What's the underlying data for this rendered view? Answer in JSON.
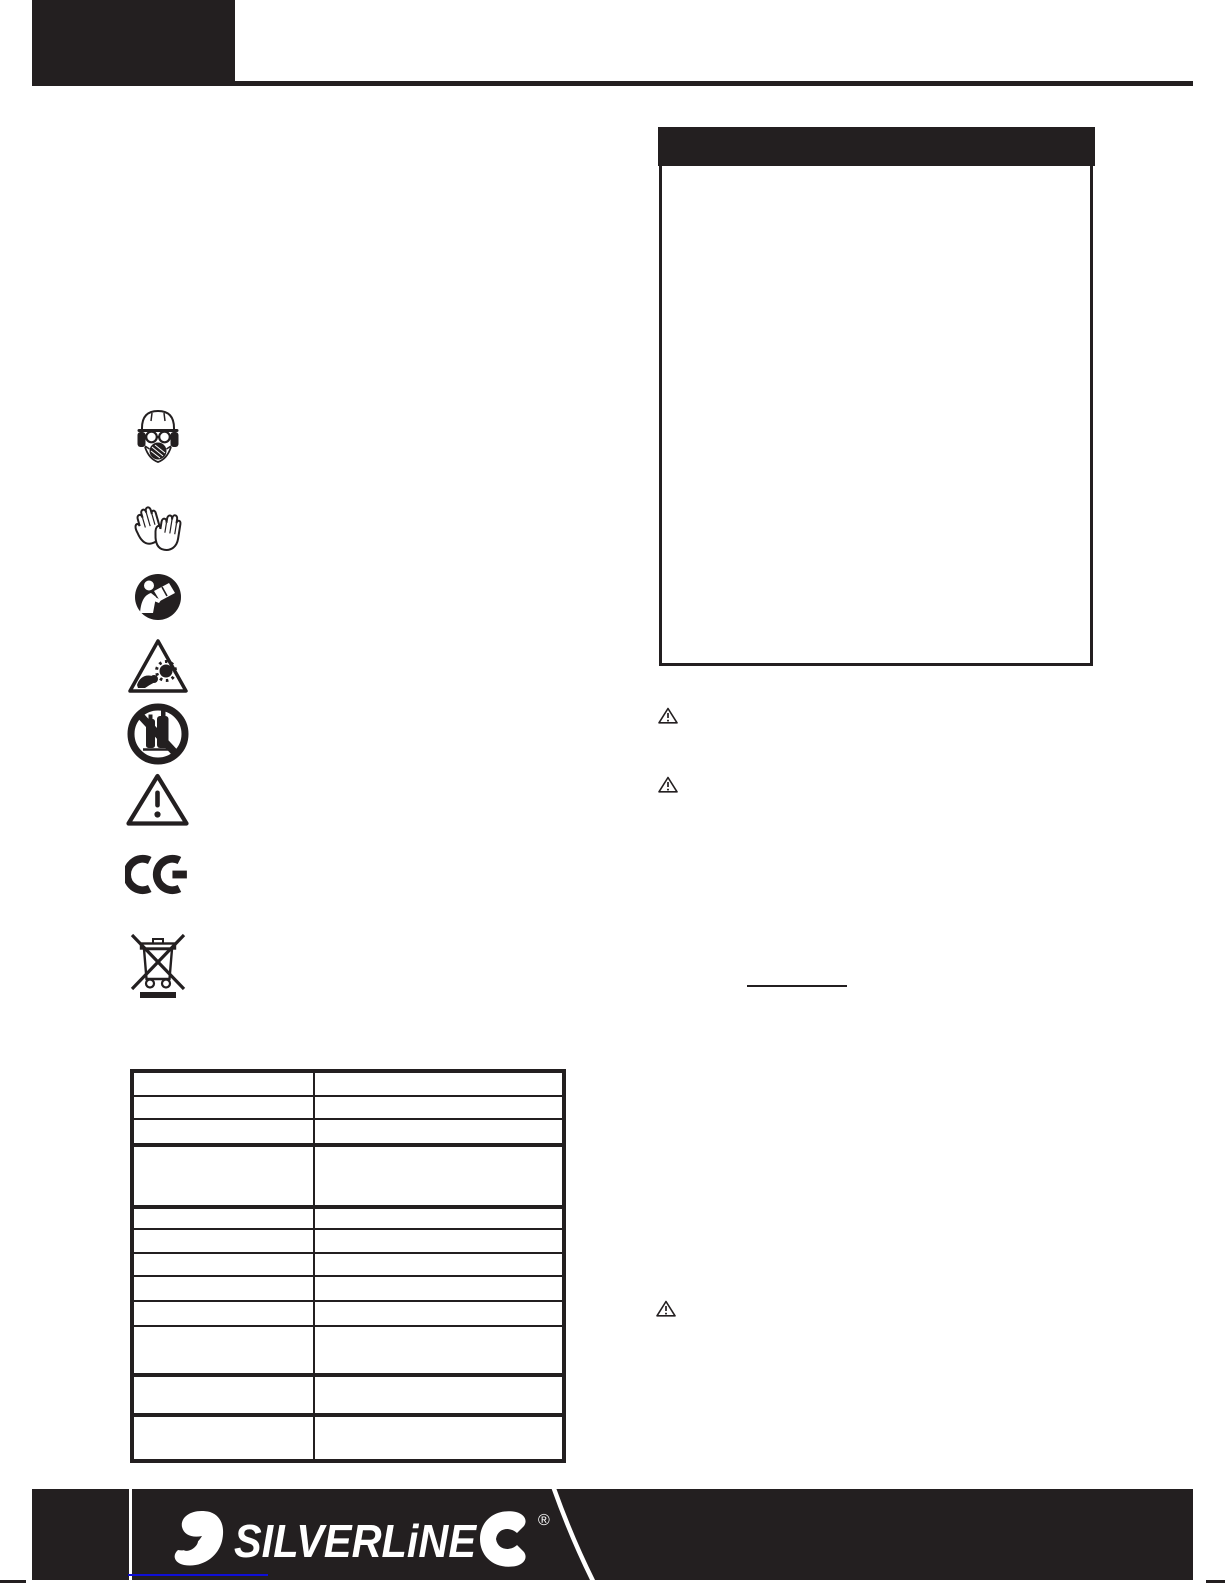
{
  "colors": {
    "ink": "#231f20",
    "paper": "#ffffff",
    "logo_white": "#ffffff",
    "link_underline_blue": "#0f0fd6"
  },
  "masthead": {
    "left_block_text": "",
    "rule_present": true
  },
  "right_column": {
    "panel_header_text": "",
    "panel_body_text": "",
    "warning_markers": [
      {
        "icon": "warning-triangle-icon"
      },
      {
        "icon": "warning-triangle-icon"
      },
      {
        "icon": "warning-triangle-icon"
      }
    ],
    "underlined_blank_text": ""
  },
  "safety_icons": [
    {
      "name": "wear-head-ear-eye-respiratory-protection-icon"
    },
    {
      "name": "wear-protective-gloves-icon"
    },
    {
      "name": "read-instruction-manual-icon"
    },
    {
      "name": "entanglement-hazard-warning-icon"
    },
    {
      "name": "no-compressed-gas-cylinders-icon"
    },
    {
      "name": "general-warning-icon"
    },
    {
      "name": "ce-conformity-mark-icon"
    },
    {
      "name": "weee-crossed-out-wheelie-bin-icon"
    }
  ],
  "spec_table": {
    "columns": 2,
    "rows": 12,
    "cells_text": "",
    "column_divider_x": 179,
    "row_separators": [
      {
        "y": 22,
        "weight": 2
      },
      {
        "y": 45,
        "weight": 2
      },
      {
        "y": 70,
        "weight": 4
      },
      {
        "y": 132,
        "weight": 4
      },
      {
        "y": 155,
        "weight": 2
      },
      {
        "y": 179,
        "weight": 2
      },
      {
        "y": 202,
        "weight": 2
      },
      {
        "y": 227,
        "weight": 2
      },
      {
        "y": 252,
        "weight": 2
      },
      {
        "y": 300,
        "weight": 4
      },
      {
        "y": 340,
        "weight": 4
      }
    ]
  },
  "footer": {
    "brand_wordmark": "SILVERLiNE",
    "registered_symbol": "®"
  }
}
